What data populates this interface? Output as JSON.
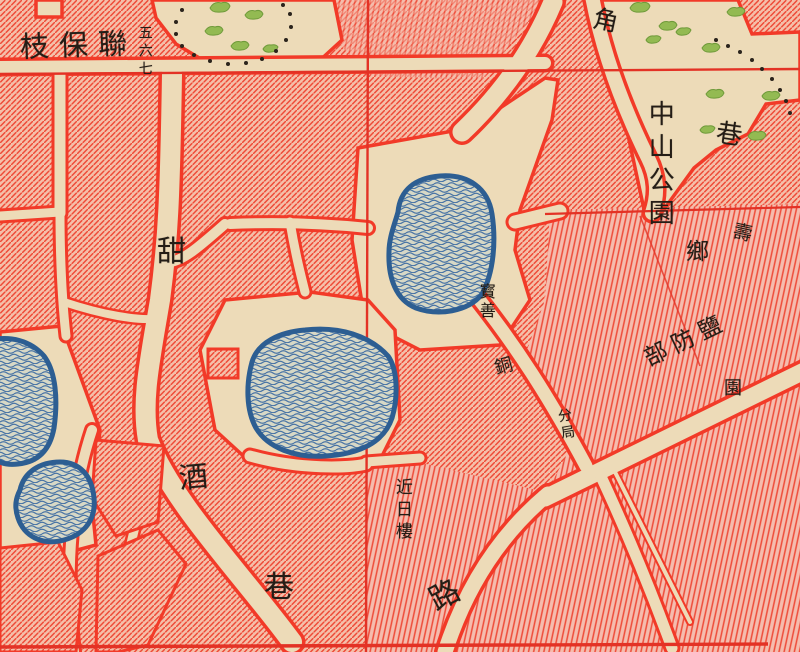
{
  "map": {
    "type": "scanned historical city map detail",
    "colors": {
      "paper_street": "#eddbb8",
      "block_fill": "#f5bfa9",
      "block_hatch_line": "#ee4a37",
      "block_border_red": "#f23a28",
      "grid_line_red": "#e33225",
      "water_outline": "#2d5e92",
      "water_fill": "#d7d8c6",
      "water_wave": "#4974a5",
      "park_green": "#93ba52",
      "boundary_dot_black": "#2b241c",
      "label_ink": "#241d16"
    }
  },
  "labels": {
    "lianbao": {
      "text": "枝保聯",
      "note_reading": "right-to-left horizontal label"
    },
    "wuliuqi": {
      "text": "五六七"
    },
    "jiao": {
      "text": "角"
    },
    "zhongshan_park": {
      "text": "中山公園"
    },
    "xiang_ne": {
      "text": "巷"
    },
    "shou": {
      "text": "壽"
    },
    "xiang_village": {
      "text": "鄉"
    },
    "yanfangbu": {
      "text": "部防鹽"
    },
    "yuan_small": {
      "text": "園"
    },
    "baoshan": {
      "text": "寳善"
    },
    "tong": {
      "text": "銅"
    },
    "fenju": {
      "text": "分局"
    },
    "tian": {
      "text": "甜"
    },
    "jiu": {
      "text": "酒"
    },
    "xiang_sw": {
      "text": "巷"
    },
    "jinrilou": {
      "text": "近日樓"
    },
    "lu": {
      "text": "路"
    }
  }
}
